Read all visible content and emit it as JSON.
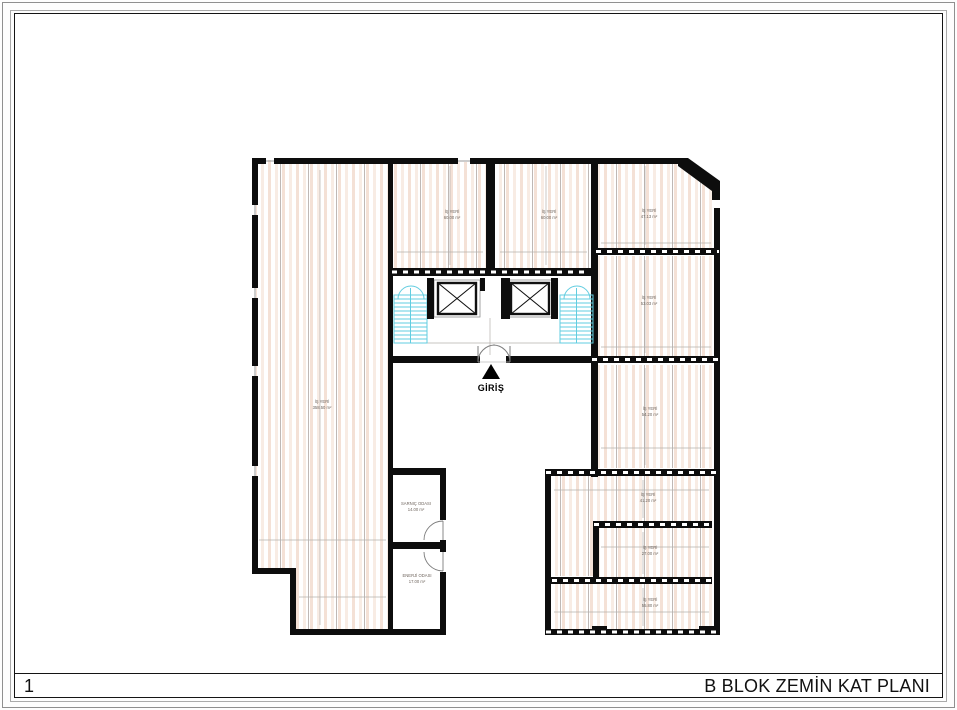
{
  "sheet": {
    "number": "1",
    "title": "B BLOK ZEMİN KAT PLANI"
  },
  "plan": {
    "entrance": {
      "label": "GİRİŞ"
    },
    "rooms": [
      {
        "id": "shop-large-west",
        "name": "İŞ YERİ",
        "area": "358.50 m²"
      },
      {
        "id": "shop-top-1",
        "name": "İŞ YERİ",
        "area": "60.00 m²"
      },
      {
        "id": "shop-top-2",
        "name": "İŞ YERİ",
        "area": "60.00 m²"
      },
      {
        "id": "shop-northeast",
        "name": "İŞ YERİ",
        "area": "47.13 m²"
      },
      {
        "id": "shop-east-1",
        "name": "İŞ YERİ",
        "area": "53.03 m²"
      },
      {
        "id": "shop-east-2",
        "name": "İŞ YERİ",
        "area": "54.20 m²"
      },
      {
        "id": "shop-southeast-1",
        "name": "İŞ YERİ",
        "area": "41.20 m²"
      },
      {
        "id": "shop-southeast-2",
        "name": "İŞ YERİ",
        "area": "27.00 m²"
      },
      {
        "id": "shop-southeast-3",
        "name": "İŞ YERİ",
        "area": "55.80 m²"
      },
      {
        "id": "cistern-room",
        "name": "SARNIÇ ODASI",
        "area": "14.00 m²"
      },
      {
        "id": "energy-room",
        "name": "ENERJİ ODASI",
        "area": "17.00 m²"
      }
    ],
    "colors": {
      "wall": "#0d0d0d",
      "hatch_stripe": "#f4e1d6",
      "stair": "#62cde0",
      "dimension": "#b5b0ac"
    }
  }
}
